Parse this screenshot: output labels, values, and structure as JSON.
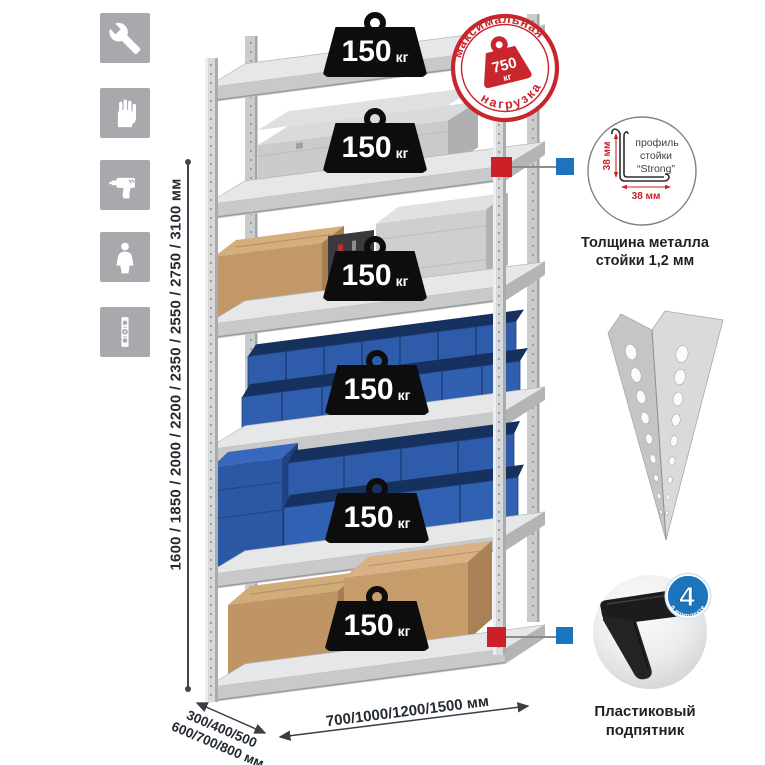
{
  "sidebar": {
    "icons": [
      {
        "id": "wrench"
      },
      {
        "id": "gloves"
      },
      {
        "id": "drill"
      },
      {
        "id": "person"
      },
      {
        "id": "level"
      }
    ]
  },
  "dimensions": {
    "height_label": "1600 / 1850 / 2000 / 2200 / 2350 / 2550 / 2750 / 3100 мм",
    "depth_label_line1": "300/400/500",
    "depth_label_line2": "600/700/800 мм",
    "width_label": "700/1000/1200/1500 мм"
  },
  "shelves": [
    {
      "load": "150",
      "unit": "кг"
    },
    {
      "load": "150",
      "unit": "кг"
    },
    {
      "load": "150",
      "unit": "кг"
    },
    {
      "load": "150",
      "unit": "кг"
    },
    {
      "load": "150",
      "unit": "кг"
    },
    {
      "load": "150",
      "unit": "кг"
    }
  ],
  "max_load_stamp": {
    "arc_top": "максимальная",
    "arc_bottom": "нагрузка",
    "value": "750",
    "unit": "кг"
  },
  "profile_callout": {
    "dim_vertical": "38 мм",
    "dim_horizontal": "38 мм",
    "label_line1": "профиль",
    "label_line2": "стойки",
    "label_line3": "“Strong”",
    "caption_line1": "Толщина металла",
    "caption_line2": "стойки 1,2 мм"
  },
  "foot_callout": {
    "badge_value": "4",
    "badge_arc_text": "в комплекте",
    "caption_line1": "Пластиковый",
    "caption_line2": "подпятник"
  },
  "colors": {
    "accent_red": "#cb2026",
    "accent_blue": "#1c75bc",
    "bin_blue": "#2f5dad",
    "metal_gray": "#d6d8da",
    "icon_gray": "#a7a9ac",
    "text_dark": "#232a31"
  }
}
